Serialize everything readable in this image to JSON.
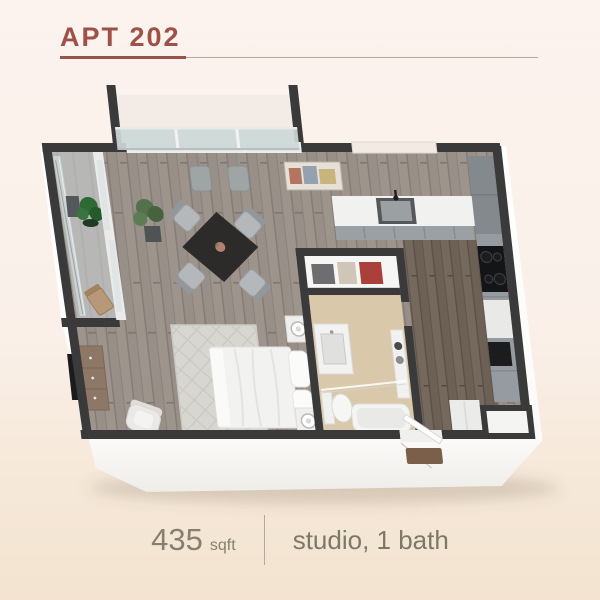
{
  "header": {
    "title": "APT 202"
  },
  "footer": {
    "area_value": "435",
    "area_unit": "sqft",
    "details": "studio, 1 bath"
  },
  "colors": {
    "accent": "#9e5148",
    "wall": "#3a3a3a",
    "background_top": "#fcf3ee",
    "background_bottom": "#f3e3d0",
    "floor_wood_light": "#978f88",
    "floor_wood_hall": "#6d6156",
    "floor_bathroom": "#d9c8a9",
    "balcony_concrete": "#b7b7b5",
    "cabinet_gray": "#959ba0",
    "doormat_brown": "#7b5f4a"
  }
}
